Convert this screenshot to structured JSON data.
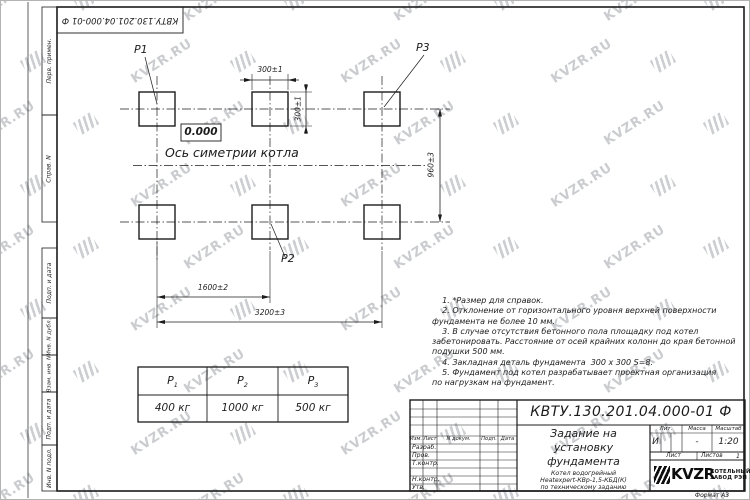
{
  "watermark": {
    "text": "KVZR.RU"
  },
  "frame": {
    "top_stamp": "КВТУ.130.201.04.000-01 Ф",
    "margin_labels": [
      "Перв. примен.",
      "Справ. N",
      "Подп. и дата",
      "Инв. N дубл.",
      "Взам. инв. N",
      "Подп. и дата",
      "Инв. N подл."
    ],
    "format_note": "Формат А3"
  },
  "drawing": {
    "labels": {
      "p1": "P1",
      "p2": "P2",
      "p3": "P3"
    },
    "elevation": "0.000",
    "axis_caption": "Ось симетрии котла",
    "dims": {
      "pad_width": "300±1",
      "pad_height": "300±1",
      "row_pitch": "960±3",
      "half_pitch": "1600±2",
      "full_pitch": "3200±3"
    }
  },
  "notes": [
    "    1. *Размер для справок.",
    "    2. Отклонение от горизонтального уровня верхней поверхности",
    "фундамента не более 10 мм.",
    "    3. В случае отсутствия бетонного пола площадку под котел",
    "забетонировать. Расстояние от осей крайних колонн до края бетонной",
    "подушки 500 мм.",
    "    4. Закладная деталь фундамента  300 х 300 S=8.",
    "    5. Фундамент под котел разрабатывает проектная организация",
    "по нагрузкам на фундамент."
  ],
  "load_table": {
    "headers": [
      [
        "P",
        "1"
      ],
      [
        "P",
        "2"
      ],
      [
        "P",
        "3"
      ]
    ],
    "values": [
      "400 кг",
      "1000 кг",
      "500 кг"
    ]
  },
  "title_block": {
    "doc_number": "КВТУ.130.201.04.000-01 Ф",
    "title": [
      "Задание на",
      "установку",
      "фундамента"
    ],
    "subtitle": [
      "Котел водогрейный",
      "Heatexpert-КВр-1,5-КБД(К)",
      "по техническому заданию"
    ],
    "columns": [
      "Изм.",
      "Лист",
      "N докум.",
      "Подп.",
      "Дата"
    ],
    "rows": [
      "Разраб.",
      "Пров.",
      "Т.контр.",
      "Н.контр.",
      "Утв."
    ],
    "lit": {
      "label": "Лит.",
      "value": "И"
    },
    "mass": {
      "label": "Масса",
      "value": "-"
    },
    "scale": {
      "label": "Масштаб",
      "value": "1:20"
    },
    "sheet": {
      "label": "Лист"
    },
    "sheets": {
      "label": "Листов",
      "value": "1"
    },
    "company": {
      "name": "KVZR",
      "line1": "КОТЕЛЬНЫЙ",
      "line2": "ЗАВОД РЭП"
    }
  }
}
